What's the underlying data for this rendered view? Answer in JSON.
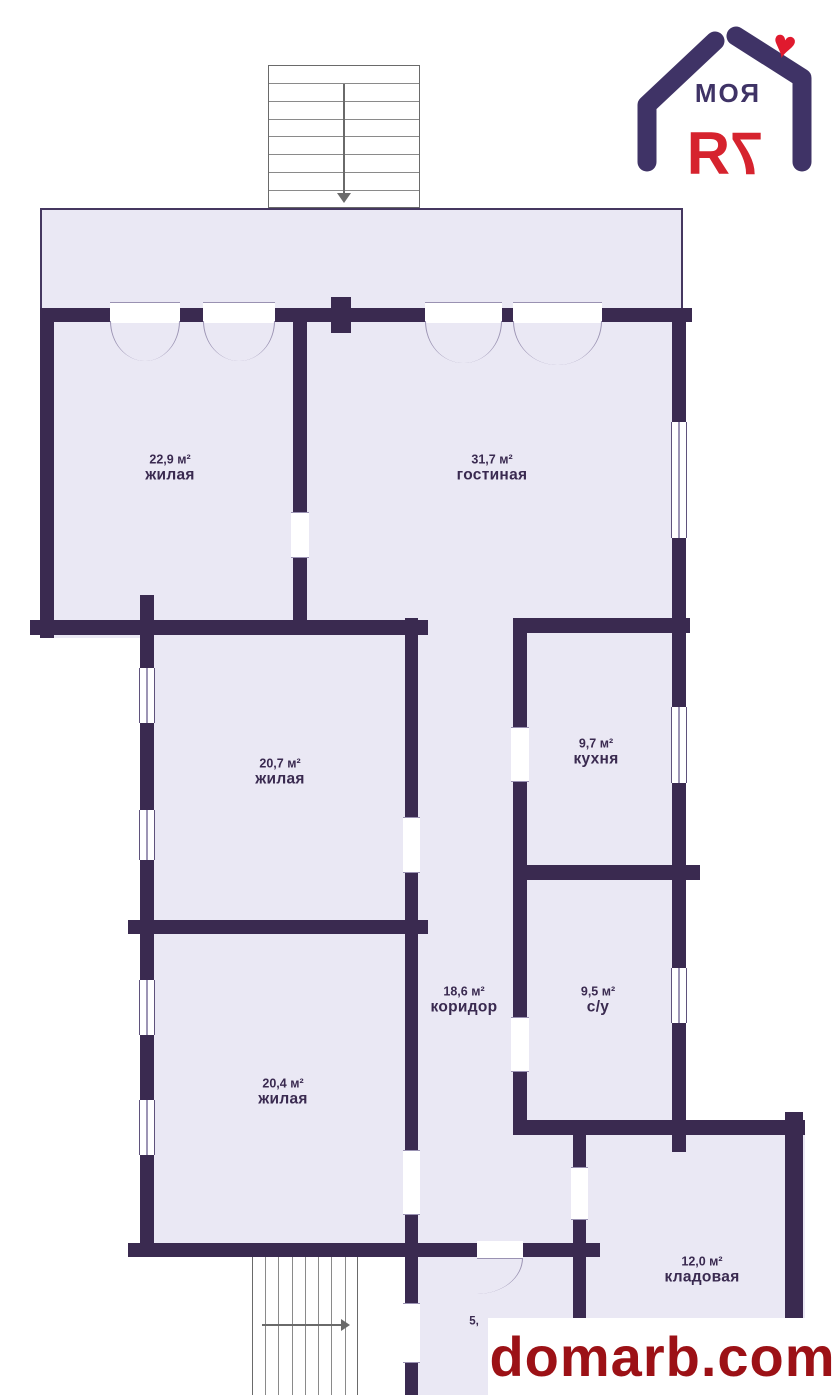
{
  "logo": {
    "brand_top": "МОЯ",
    "brand_bottom": "7Я",
    "heart": "♥"
  },
  "watermark": {
    "text": "domarb.com"
  },
  "rooms": [
    {
      "area": "22,9 м²",
      "name": "жилая"
    },
    {
      "area": "31,7 м²",
      "name": "гостиная"
    },
    {
      "area": "20,7 м²",
      "name": "жилая"
    },
    {
      "area": "9,7 м²",
      "name": "кухня"
    },
    {
      "area": "18,6 м²",
      "name": "коридор"
    },
    {
      "area": "9,5 м²",
      "name": "с/у"
    },
    {
      "area": "20,4 м²",
      "name": "жилая"
    },
    {
      "area": "12,0 м²",
      "name": "кладовая"
    },
    {
      "area": "5,",
      "name": ""
    }
  ],
  "colors": {
    "wall": "#3a2a50",
    "room_fill": "#eae8f4",
    "logo_purple": "#3f3366",
    "logo_red": "#d6232e",
    "watermark_red": "#9c1116"
  }
}
